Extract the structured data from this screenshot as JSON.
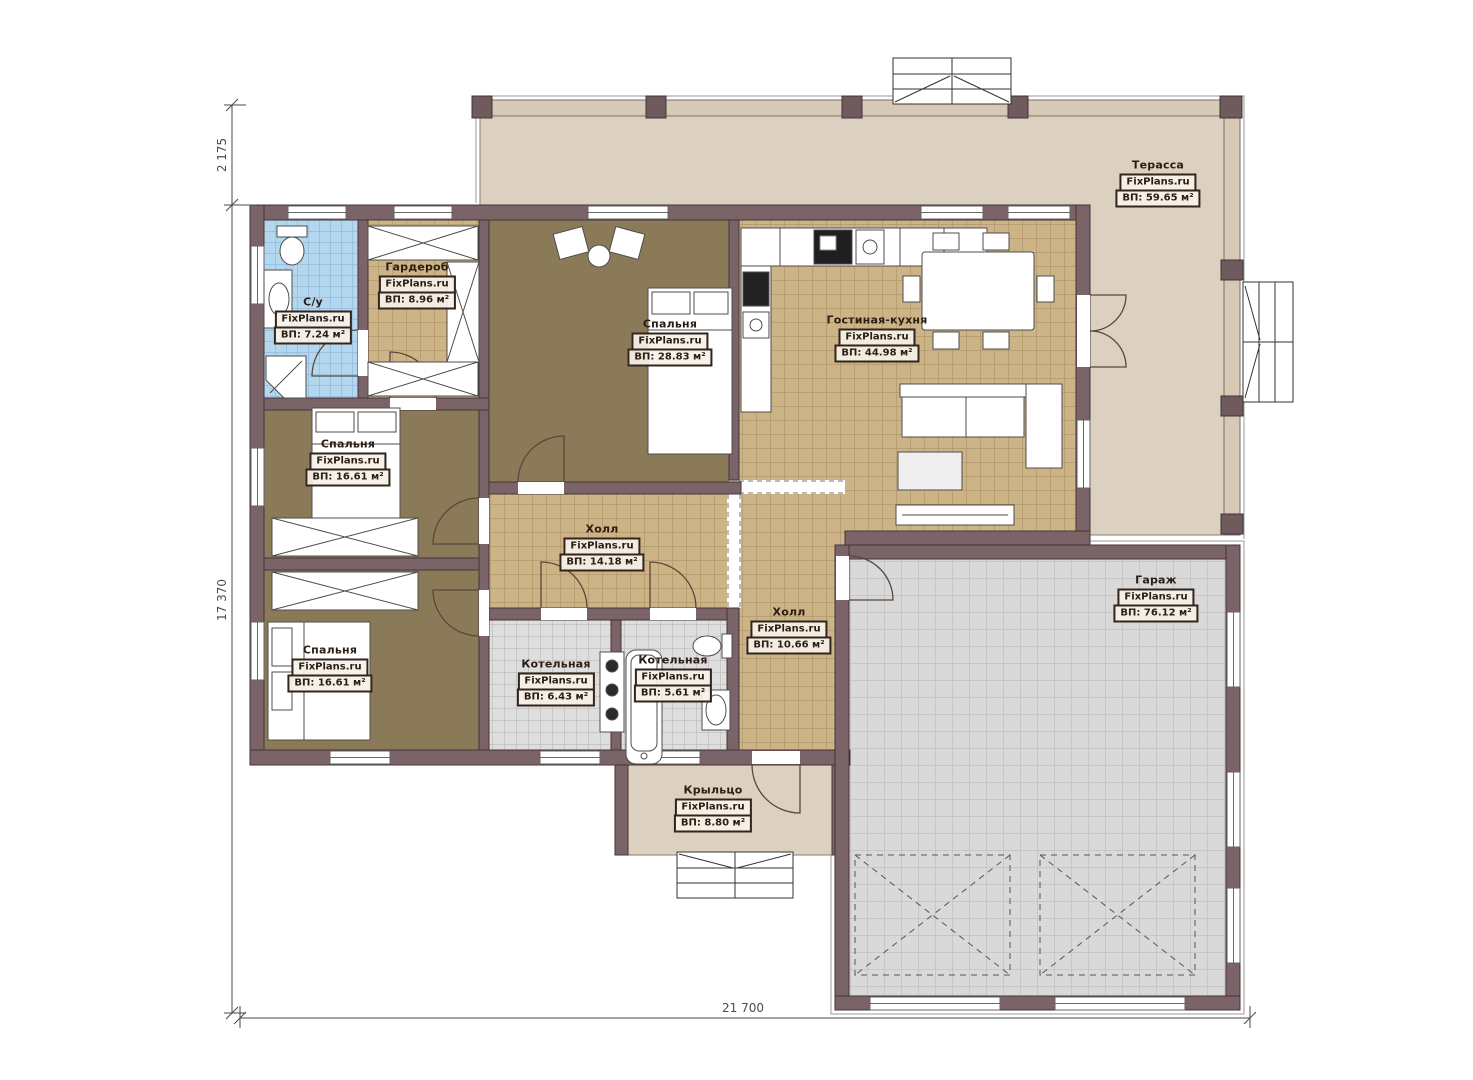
{
  "plan": {
    "watermark": "FixPlans.ru",
    "rooms": [
      {
        "name": "Терасса",
        "area": "ВП: 59.65 м²"
      },
      {
        "name": "С/у",
        "area": "ВП: 7.24 м²"
      },
      {
        "name": "Гардероб",
        "area": "ВП: 8.96 м²"
      },
      {
        "name": "Спальня",
        "area": "ВП: 28.83 м²"
      },
      {
        "name": "Гостиная-кухня",
        "area": "ВП: 44.98 м²"
      },
      {
        "name": "Спальня",
        "area": "ВП: 16.61 м²"
      },
      {
        "name": "Холл",
        "area": "ВП: 14.18 м²"
      },
      {
        "name": "Спальня",
        "area": "ВП: 16.61 м²"
      },
      {
        "name": "Котельная",
        "area": "ВП: 6.43 м²"
      },
      {
        "name": "Котельная",
        "area": "ВП: 5.61 м²"
      },
      {
        "name": "Холл",
        "area": "ВП: 10.66 м²"
      },
      {
        "name": "Гараж",
        "area": "ВП: 76.12 м²"
      },
      {
        "name": "Крыльцо",
        "area": "ВП: 8.80 м²"
      }
    ],
    "dimensions": {
      "offset_top_left": "2 175",
      "height_left": "17 370",
      "width_bottom": "21 700"
    },
    "palette": {
      "wall": "#7b6467",
      "wall_outline": "#443438",
      "tile_floor": "#ccb487",
      "bedroom_floor": "#8b7a58",
      "bathroom_tile": "#b4d7f0",
      "utility_tile": "#dedede",
      "terrace_floor": "#dcd1c0",
      "label_ink": "#32241c"
    }
  }
}
